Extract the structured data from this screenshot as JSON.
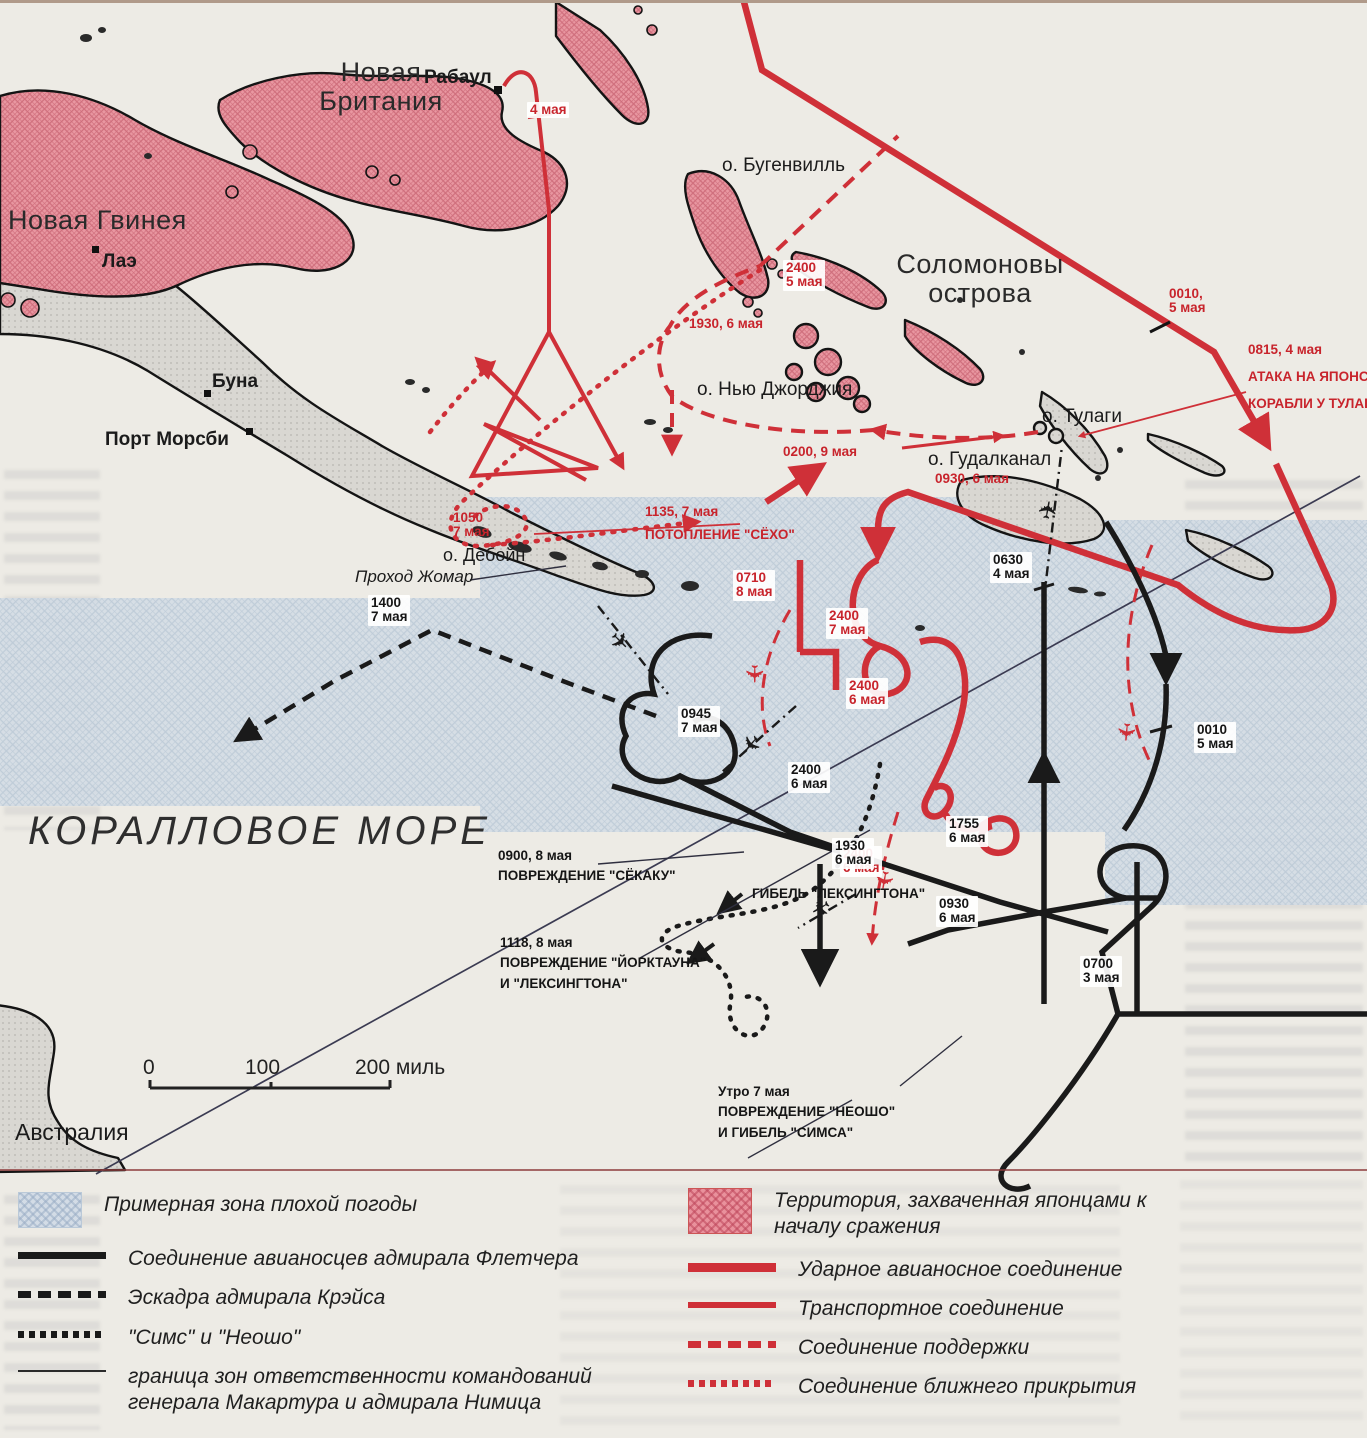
{
  "map_title": "Battle of the Coral Sea map",
  "colors": {
    "japanese_red": "#cf3038",
    "allied_black": "#1a1a1a",
    "weather_blue": "#d3dce6",
    "territory_pink": "#e9919c",
    "paper": "#edebe5"
  },
  "places": {
    "new_britain_1": "Новая",
    "new_britain_2": "Британия",
    "rabaul": "Рабаул",
    "new_guinea": "Новая Гвинея",
    "lae": "Лаэ",
    "buna": "Буна",
    "port_moresby": "Порт Морсби",
    "bougainville": "о. Бугенвилль",
    "solomon_1": "Соломоновы",
    "solomon_2": "острова",
    "new_georgia": "о. Нью Джорджия",
    "tulagi": "о. Тулаги",
    "guadalcanal": "о. Гудалканал",
    "deboyne": "о. Дебойн",
    "jomard": "Проход Жомар",
    "coral_sea": "КОРАЛЛОВОЕ МОРЕ",
    "australia": "Австралия"
  },
  "red_labels": {
    "may4": "4 мая",
    "t2400_5_1": "2400",
    "t2400_5_2": "5 мая",
    "t1930_6": "1930, 6 мая",
    "t0010_5_1": "0010,",
    "t0010_5_2": "5 мая",
    "t0815_1": "0815, 4 мая",
    "t0815_2": "АТАКА НА ЯПОНСКИЕ",
    "t0815_3": "КОРАБЛИ У ТУЛАГИ",
    "t0200_9": "0200, 9 мая",
    "t0930_6": "0930, 6 мая",
    "t1050_1": "1050",
    "t1050_2": "7 мая",
    "t1135_1": "1135, 7 мая",
    "t1135_2": "ПОТОПЛЕНИЕ \"СЁХО\"",
    "t0710_1": "0710",
    "t0710_2": "8 мая",
    "t2400_7_1": "2400",
    "t2400_7_2": "7 мая",
    "t2400_6a_1": "2400",
    "t2400_6a_2": "6 мая",
    "t2400_6b_1": "2400",
    "t2400_6b_2": "6 мая"
  },
  "black_labels": {
    "t1400_1": "1400",
    "t1400_2": "7 мая",
    "t0630_1": "0630",
    "t0630_2": "4 мая",
    "t0945_1": "0945",
    "t0945_2": "7 мая",
    "t2400_6_1": "2400",
    "t2400_6_2": "6 мая",
    "t0010_1": "0010",
    "t0010_2": "5 мая",
    "t1755_1": "1755",
    "t1755_2": "6 мая",
    "t1930_1": "1930",
    "t1930_2": "6 мая",
    "t0930_1": "0930",
    "t0930_2": "6 мая",
    "t0700_1": "0700",
    "t0700_2": "3 мая"
  },
  "annotations": {
    "shokaku_1": "0900, 8 мая",
    "shokaku_2": "ПОВРЕЖДЕНИЕ \"СЁКАКУ\"",
    "yorktown_1": "1118, 8 мая",
    "yorktown_2": "ПОВРЕЖДЕНИЕ \"ЙОРКТАУНА\"",
    "yorktown_3": "И \"ЛЕКСИНГТОНА\"",
    "lexington": "ГИБЕЛЬ \"ЛЕКСИНГТОНА\"",
    "neosho_1": "Утро 7 мая",
    "neosho_2": "ПОВРЕЖДЕНИЕ \"НЕОШО\"",
    "neosho_3": "И ГИБЕЛЬ \"СИМСА\""
  },
  "scale": {
    "v0": "0",
    "v100": "100",
    "v200": "200 миль"
  },
  "legend": {
    "left": [
      {
        "swatch": "weather-zone",
        "label": "Примерная зона плохой погоды"
      },
      {
        "swatch": "black-thick-line",
        "label": "Соединение авианосцев адмирала Флетчера"
      },
      {
        "swatch": "black-dashed-line",
        "label": "Эскадра адмирала Крэйса"
      },
      {
        "swatch": "black-dotted-line",
        "label": "\"Симс\" и \"Неошо\""
      },
      {
        "swatch": "thin-line",
        "label": "граница зон ответственности командований генерала Макартура и адмирала Нимица"
      }
    ],
    "right": [
      {
        "swatch": "japanese-territory",
        "label": "Территория, захваченная японцами к началу сражения"
      },
      {
        "swatch": "red-thick-line",
        "label": "Ударное авианосное соединение"
      },
      {
        "swatch": "red-medium-line",
        "label": "Транспортное соединение"
      },
      {
        "swatch": "red-dashed-line",
        "label": "Соединение поддержки"
      },
      {
        "swatch": "red-dotted-line",
        "label": "Соединение ближнего прикрытия"
      }
    ]
  }
}
